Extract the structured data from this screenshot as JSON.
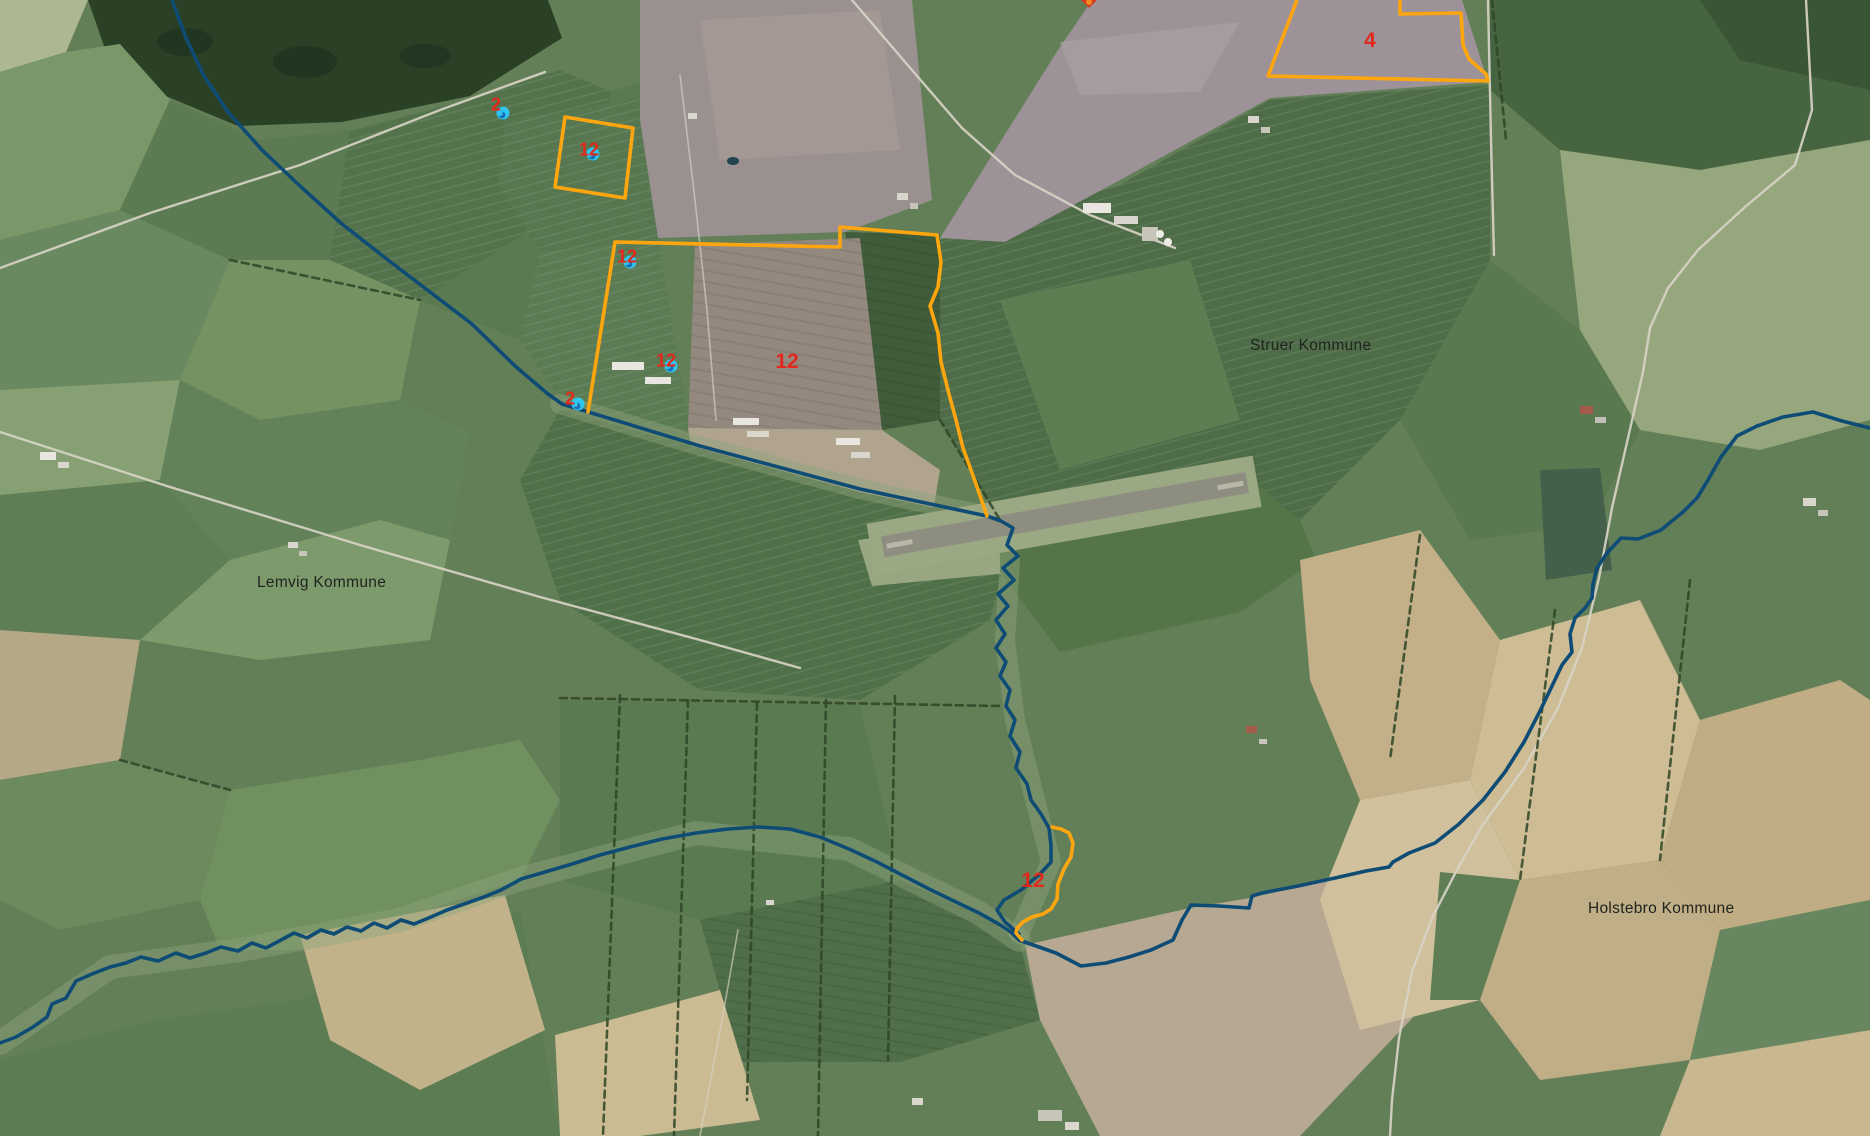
{
  "map": {
    "title": "Municipal aerial map",
    "municipalities": [
      {
        "id": "lemvig",
        "name": "Lemvig Kommune",
        "x": 257,
        "y": 574
      },
      {
        "id": "struer",
        "name": "Struer Kommune",
        "x": 1250,
        "y": 337
      },
      {
        "id": "holstebro",
        "name": "Holstebro Kommune",
        "x": 1588,
        "y": 900
      }
    ],
    "parcel_labels": [
      {
        "id": "4",
        "text": "4",
        "x": 1370,
        "y": 41
      },
      {
        "id": "12-main",
        "text": "12",
        "x": 787,
        "y": 362
      },
      {
        "id": "12-south",
        "text": "12",
        "x": 1033,
        "y": 881
      }
    ],
    "markers": [
      {
        "id": "m1",
        "text": "2",
        "x": 503,
        "y": 113,
        "lx": 496,
        "ly": 105
      },
      {
        "id": "m2",
        "text": "12",
        "x": 593,
        "y": 154,
        "lx": 589,
        "ly": 150
      },
      {
        "id": "m3",
        "text": "12",
        "x": 630,
        "y": 262,
        "lx": 627,
        "ly": 257
      },
      {
        "id": "m4",
        "text": "12",
        "x": 671,
        "y": 366,
        "lx": 666,
        "ly": 361
      },
      {
        "id": "m5",
        "text": "2",
        "x": 578,
        "y": 404,
        "lx": 570,
        "ly": 399
      }
    ],
    "parcel_outlines": [
      {
        "id": "parcel-4",
        "d": "M 1400,0 L 1400,14 L 1461,13 L 1463,45 L 1469,59 L 1479,68 L 1486,74 L 1488,81 L 1268,76 L 1297,0"
      },
      {
        "id": "parcel-12-square",
        "d": "M 565,117 L 633,128 L 625,198 L 555,187 Z"
      },
      {
        "id": "parcel-12-main",
        "d": "M 588,412 L 615,242 L 840,247 L 840,227 L 937,235 L 941,262 L 938,287 L 930,306 L 938,333 L 941,362 L 949,394 L 956,420 L 963,448 L 976,484 L 987,516"
      },
      {
        "id": "parcel-12-south",
        "d": "M 1052,827 L 1061,829 L 1069,833 L 1073,843 L 1071,857 L 1064,869 L 1058,884 L 1057,899 L 1051,909 L 1043,914 L 1032,917 L 1023,922 L 1017,928 L 1016,933 L 1022,940"
      }
    ],
    "boundaries": [
      {
        "id": "lemvig-struer",
        "d": "M 172,0 L 186,38 L 204,76 L 228,112 L 262,150 L 300,186 L 342,224 L 388,260 L 430,292 L 472,324 L 515,366 L 548,394 L 562,404 L 700,446 L 860,489 L 987,516 L 1001,521 L 1013,528 L 1007,545 L 1018,556 L 1003,568 L 1014,580 L 998,594 L 1008,606 L 996,620 L 1005,634 L 996,648 L 1006,662 L 1000,676 L 1010,690 L 1006,706 L 1015,720 L 1010,736 L 1020,752 L 1016,768 L 1027,784 L 1031,800 L 1041,814 L 1049,828 L 1051,845 L 1051,862 L 1040,874 L 1021,890 L 1004,900 L 997,910 L 1005,922 L 1019,934"
      },
      {
        "id": "lemvig-holstebro",
        "d": "M 0,1043 L 16,1037 L 33,1027 L 47,1017 L 52,1004 L 66,998 L 76,981 L 92,974 L 110,967 L 126,963 L 141,957 L 158,961 L 176,953 L 190,958 L 206,953 L 221,947 L 238,951 L 252,943 L 266,948 L 281,940 L 294,933 L 307,938 L 321,930 L 334,934 L 347,927 L 361,931 L 374,923 L 387,928 L 401,920 L 414,924 L 431,917 L 447,910 L 467,903 L 484,897 L 501,890 L 514,883 L 521,879 L 545,872 L 572,864 L 600,855 L 630,847 L 662,839 L 696,833 L 728,829 L 758,827 L 790,829 L 820,837 L 849,849 L 877,862 L 904,876 L 931,890 L 956,902 L 979,913 L 997,923 L 1011,932 L 1019,940"
      },
      {
        "id": "struer-holstebro",
        "d": "M 1870,428 L 1842,421 L 1813,412 L 1783,417 L 1757,426 L 1737,436 L 1721,457 L 1708,480 L 1697,498 L 1683,512 L 1661,530 L 1638,539 L 1621,538 L 1607,553 L 1597,568 L 1593,584 L 1592,598 L 1585,608 L 1575,618 L 1570,634 L 1572,652 L 1562,665 L 1552,686 L 1540,711 L 1524,742 L 1505,772 L 1483,800 L 1459,824 L 1435,843 L 1409,853 L 1393,862 L 1389,867 L 1366,871 L 1335,878 L 1298,886 L 1262,893 L 1252,896 L 1249,908 L 1219,906 L 1191,905 L 1182,920 L 1173,940 L 1151,950 L 1129,957 L 1106,963 L 1081,966 L 1056,953 L 1036,946 L 1019,940"
      }
    ],
    "edge_marker": {
      "x": 1089,
      "y": 1
    },
    "colors": {
      "parcel_outline": "#FFA60F",
      "municipal_boundary": "#0E4C75",
      "parcel_label": "#E2281C",
      "marker_fill": "#2EC6EF",
      "marker_core": "#1A6DB3",
      "municipality_label": "#20241F"
    }
  }
}
